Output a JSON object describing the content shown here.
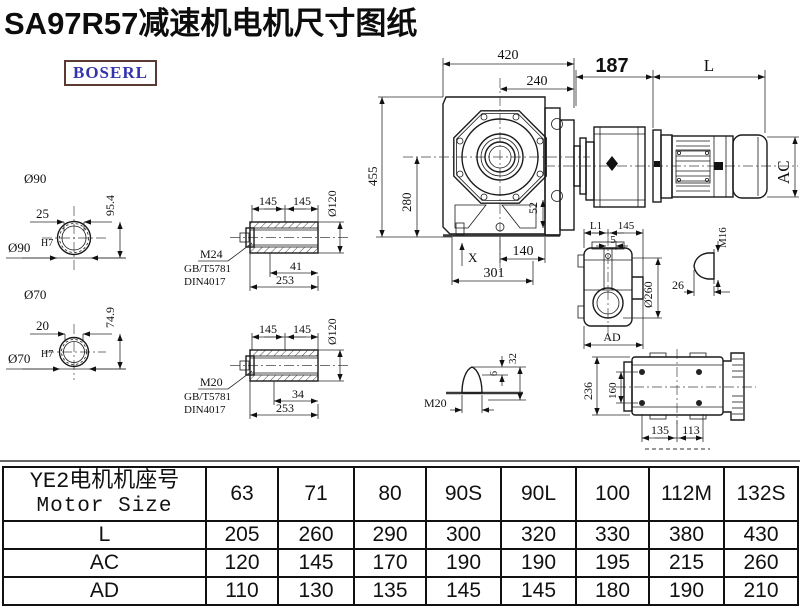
{
  "title": "SA97R57减速机电机尺寸图纸",
  "logo": "BOSERL",
  "drawing": {
    "shaft_end_a": {
      "dia_label": "Ø90",
      "width": "25",
      "height": "95.4",
      "bore_label": "Ø90",
      "bore_fit": "H7"
    },
    "shaft_end_b": {
      "dia_label": "Ø70",
      "width": "20",
      "height": "74.9",
      "bore_label": "Ø70",
      "bore_fit": "H7"
    },
    "hollow_shaft_a": {
      "l1": "145",
      "l2": "145",
      "dia": "Ø120",
      "thread": "M24",
      "std1": "GB/T5781",
      "std2": "DIN4017",
      "screw": "41",
      "total": "253"
    },
    "hollow_shaft_b": {
      "l1": "145",
      "l2": "145",
      "dia": "Ø120",
      "thread": "M20",
      "std1": "GB/T5781",
      "std2": "DIN4017",
      "screw": "34",
      "total": "253"
    },
    "front_view": {
      "width": "420",
      "width_half": "240",
      "height": "455",
      "center_height": "280",
      "offset": "52",
      "foot": "140",
      "base": "301",
      "marker": "X"
    },
    "motor": {
      "flange_len": "187",
      "len": "L",
      "dia": "AC"
    },
    "side_view": {
      "l1": "L1",
      "w145": "145",
      "w5": "5",
      "dia": "Ø260",
      "ad": "AD"
    },
    "bolt_detail": {
      "thread": "M16",
      "len": "26"
    },
    "plug_detail": {
      "thread": "M20",
      "h6": "6",
      "h32": "32"
    },
    "foot_view": {
      "h236": "236",
      "h160": "160",
      "w135": "135",
      "w113": "113"
    }
  },
  "table": {
    "header_cn": "YE2电机机座号",
    "header_en": "Motor Size",
    "sizes": [
      "63",
      "71",
      "80",
      "90S",
      "90L",
      "100",
      "112M",
      "132S"
    ],
    "rows": [
      {
        "label": "L",
        "values": [
          "205",
          "260",
          "290",
          "300",
          "320",
          "330",
          "380",
          "430"
        ]
      },
      {
        "label": "AC",
        "values": [
          "120",
          "145",
          "170",
          "190",
          "190",
          "195",
          "215",
          "260"
        ]
      },
      {
        "label": "AD",
        "values": [
          "110",
          "130",
          "135",
          "145",
          "145",
          "180",
          "190",
          "210"
        ]
      }
    ]
  }
}
